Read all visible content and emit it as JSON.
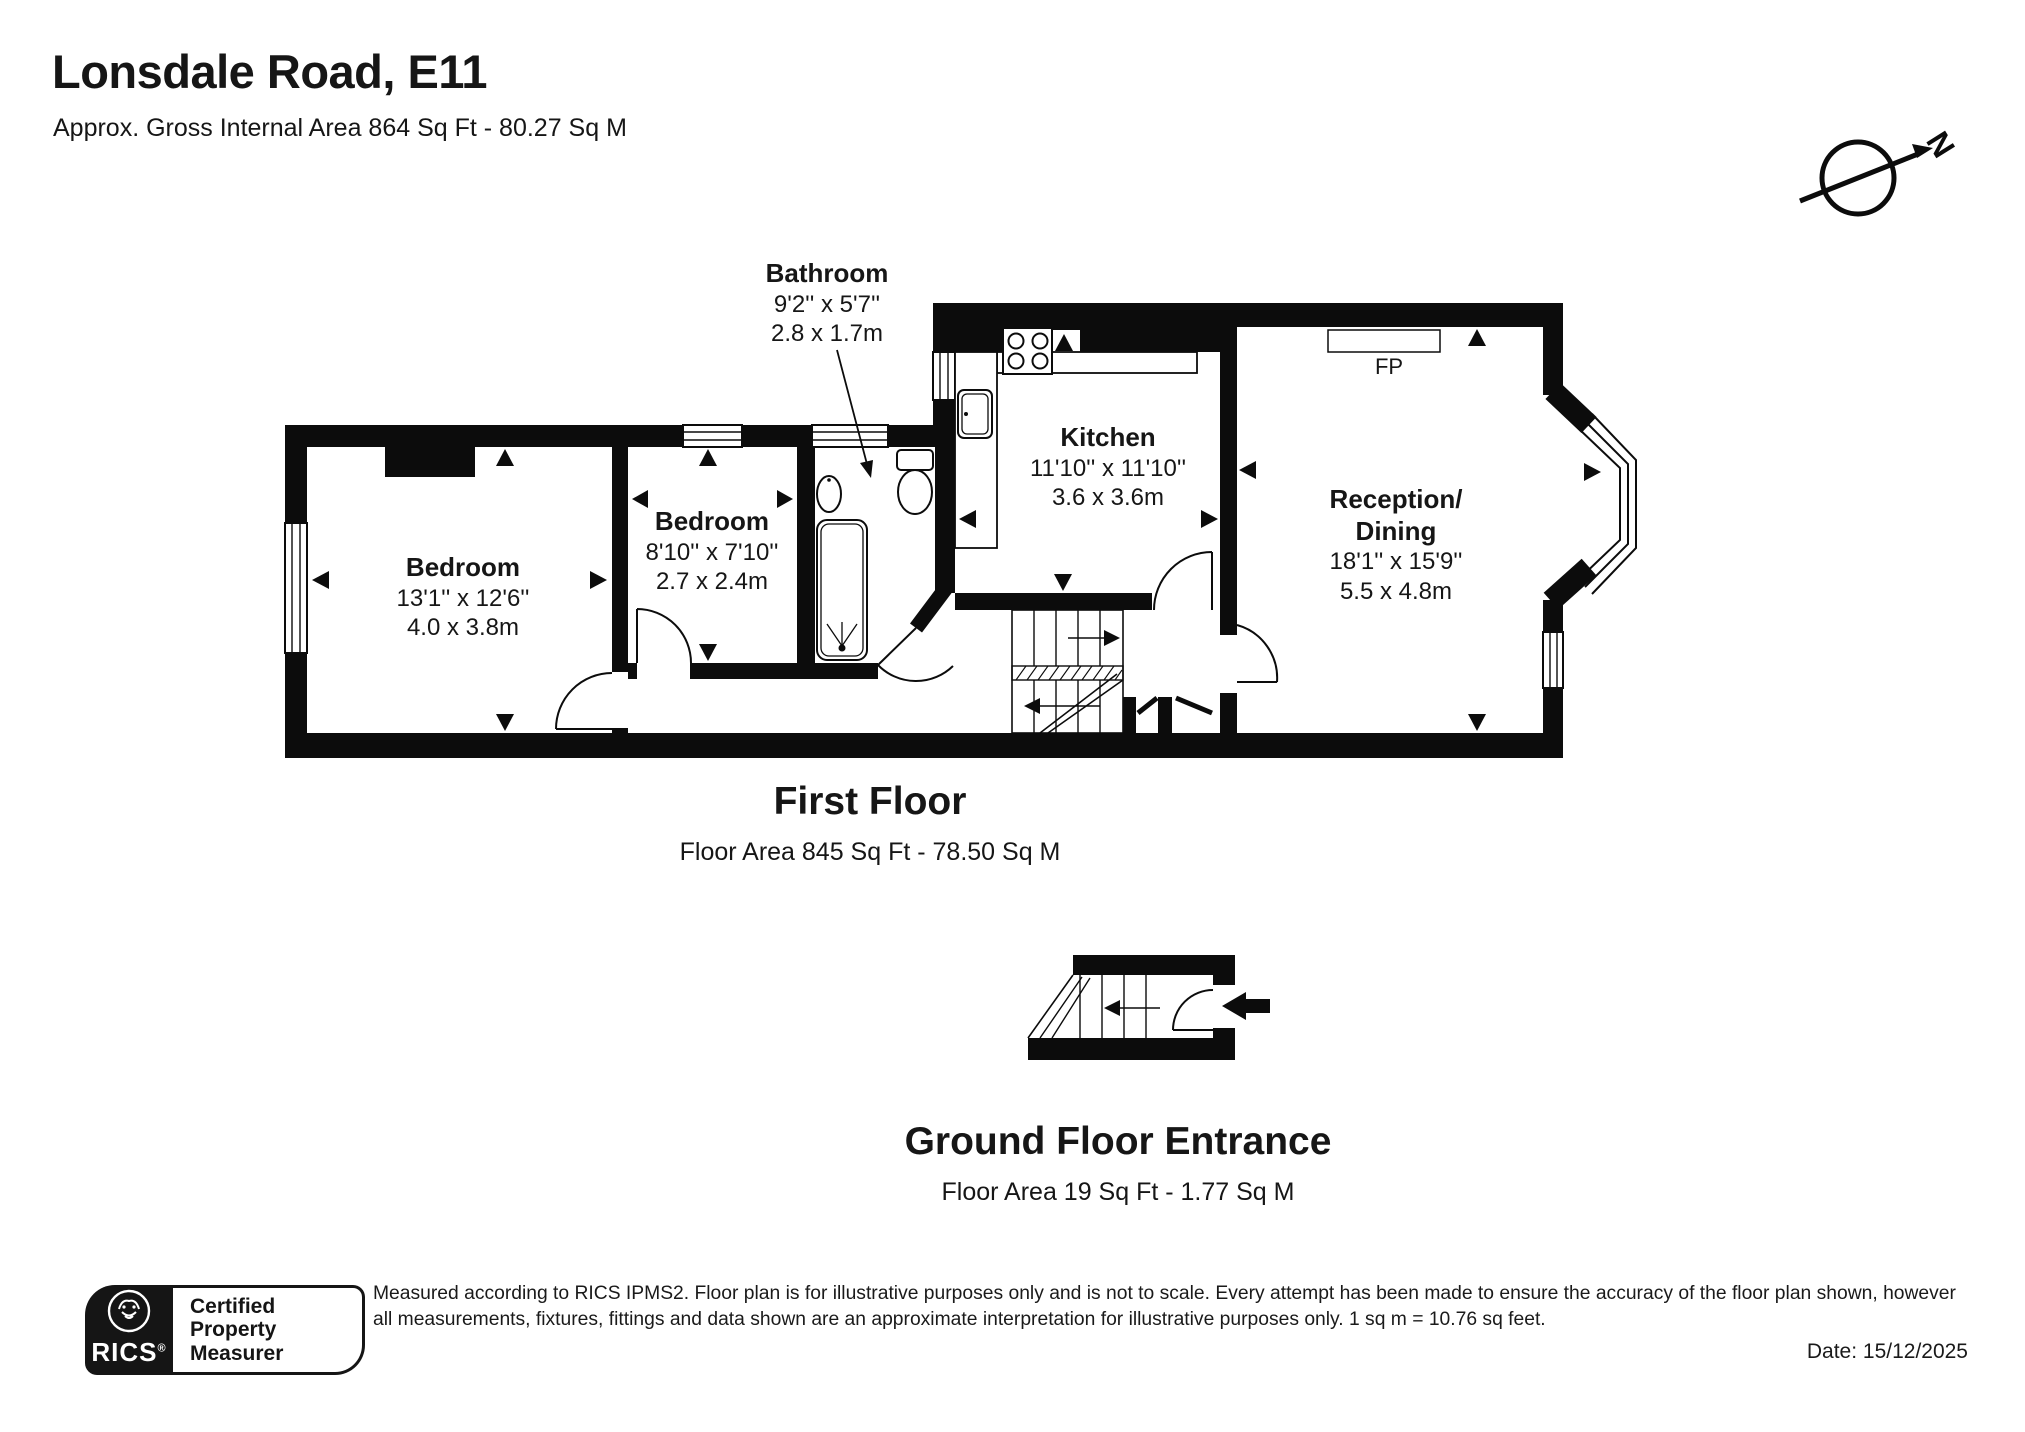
{
  "header": {
    "title": "Lonsdale Road, E11",
    "subtitle": "Approx. Gross Internal Area 864 Sq Ft - 80.27 Sq M"
  },
  "compass": {
    "north": "N"
  },
  "first_floor": {
    "heading": "First Floor",
    "area_caption": "Floor Area 845 Sq Ft - 78.50 Sq M",
    "fireplace": "FP",
    "rooms": {
      "bathroom": {
        "name": "Bathroom",
        "imperial": "9'2'' x 5'7''",
        "metric": "2.8 x 1.7m"
      },
      "bedroom_left": {
        "name": "Bedroom",
        "imperial": "13'1'' x 12'6''",
        "metric": "4.0 x 3.8m"
      },
      "bedroom_middle": {
        "name": "Bedroom",
        "imperial": "8'10'' x 7'10''",
        "metric": "2.7 x 2.4m"
      },
      "kitchen": {
        "name": "Kitchen",
        "imperial": "11'10'' x 11'10''",
        "metric": "3.6 x 3.6m"
      },
      "reception": {
        "name_line1": "Reception/",
        "name_line2": "Dining",
        "imperial": "18'1'' x 15'9''",
        "metric": "5.5 x 4.8m"
      }
    }
  },
  "ground_floor": {
    "heading": "Ground Floor Entrance",
    "area_caption": "Floor Area 19 Sq Ft - 1.77 Sq M"
  },
  "footer": {
    "rics_badge": {
      "brand": "RICS",
      "registered": "®",
      "line1": "Certified",
      "line2": "Property",
      "line3": "Measurer"
    },
    "disclaimer": "Measured according to RICS IPMS2. Floor plan is for illustrative purposes only and is not to scale. Every attempt has been made to ensure the accuracy of the floor plan shown, however all measurements, fixtures, fittings and data shown are an approximate interpretation for illustrative purposes only. 1 sq m = 10.76 sq feet.",
    "date": "Date: 15/12/2025"
  }
}
